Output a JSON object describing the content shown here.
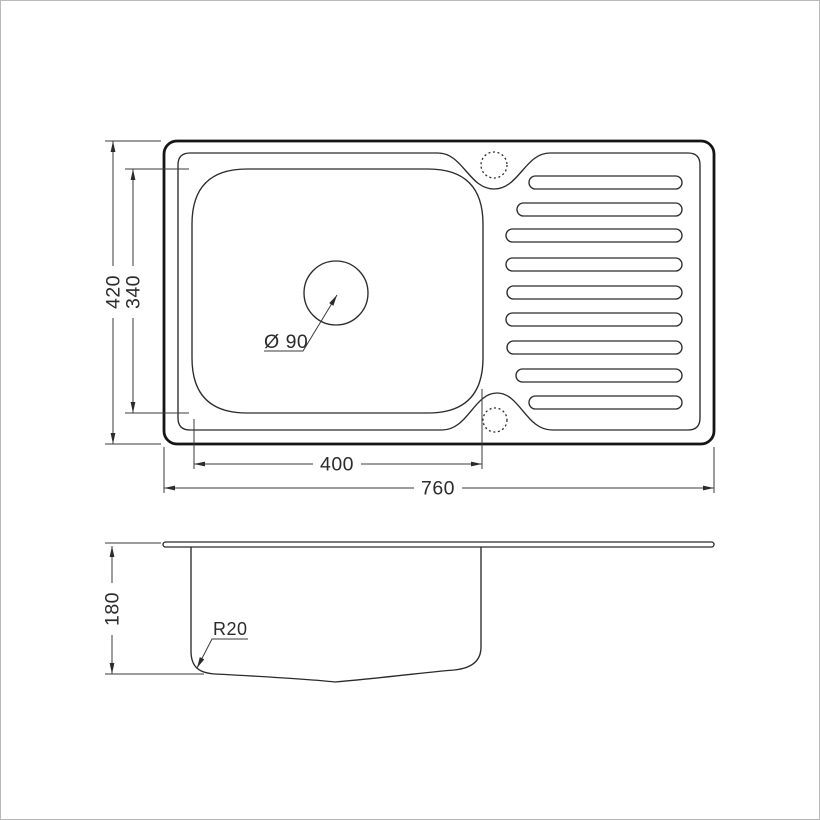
{
  "drawing": {
    "type": "kitchen-sink-technical-drawing",
    "colors": {
      "background": "#ffffff",
      "thin_line": "#2b2b2b",
      "thick_line": "#151515",
      "dimension_line": "#3a3a3a",
      "frame_border": "#b9b9b9"
    },
    "top_view": {
      "overall_length_label": "760",
      "overall_width_label": "420",
      "bowl_length_label": "400",
      "bowl_width_label": "340",
      "drain_diameter_label": "Ø 90"
    },
    "side_view": {
      "bowl_depth_label": "180",
      "bottom_corner_radius_label": "R20"
    }
  }
}
